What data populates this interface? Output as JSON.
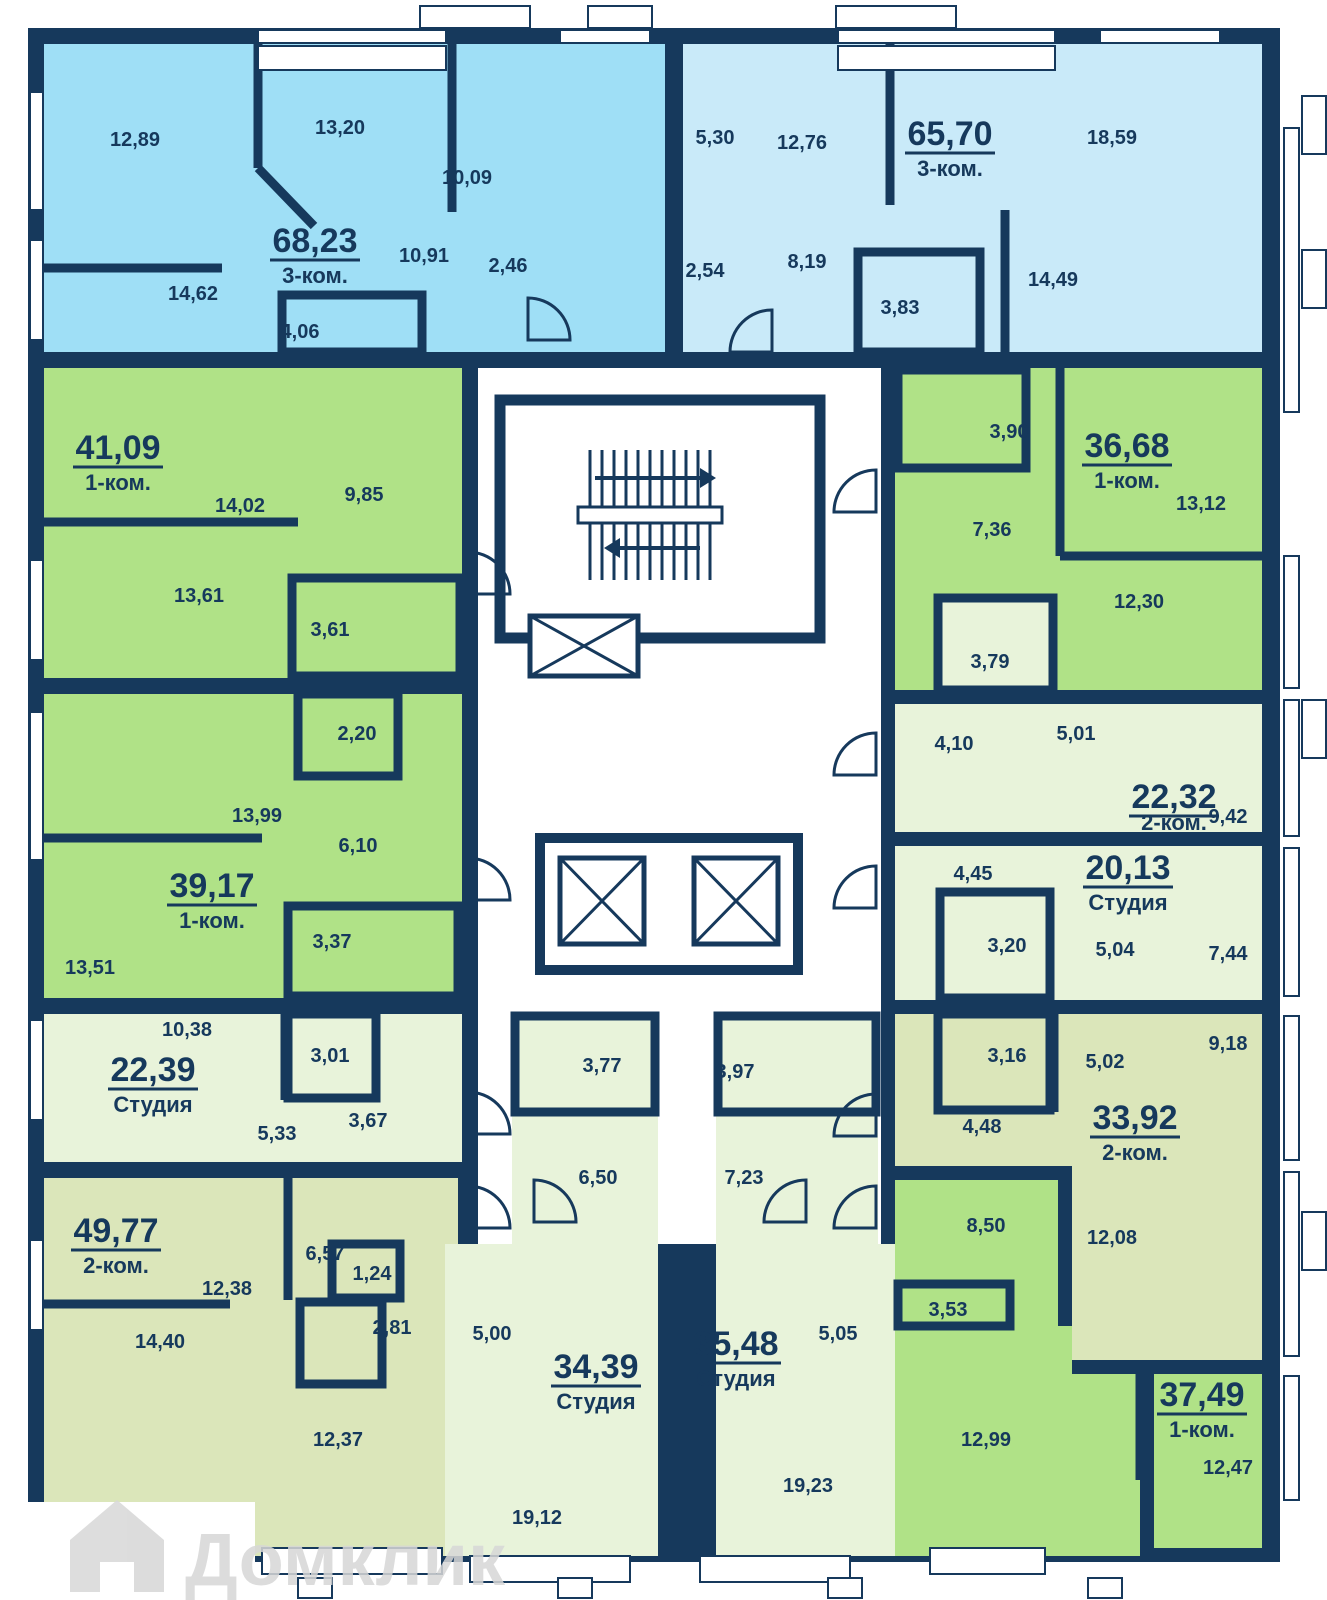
{
  "plan": {
    "watermark": "Домклик",
    "colors": {
      "wall": "#16395c",
      "bright_blue": "#9fdff6",
      "pale_blue": "#c9eaf9",
      "green": "#b0e287",
      "pale_green": "#e8f3da",
      "olive": "#dbe6ba",
      "background": "#ffffff"
    }
  },
  "apartments": [
    {
      "id": "68-23",
      "area": "68,23",
      "type": "3-ком.",
      "color": "#9fdff6",
      "rooms": [
        "12,89",
        "13,20",
        "10,09",
        "10,91",
        "2,46",
        "14,62",
        "4,06"
      ]
    },
    {
      "id": "65-70",
      "area": "65,70",
      "type": "3-ком.",
      "color": "#c9eaf9",
      "rooms": [
        "5,30",
        "12,76",
        "18,59",
        "2,54",
        "8,19",
        "3,83",
        "14,49"
      ]
    },
    {
      "id": "41-09",
      "area": "41,09",
      "type": "1-ком.",
      "color": "#b0e287",
      "rooms": [
        "14,02",
        "9,85",
        "13,61",
        "3,61"
      ]
    },
    {
      "id": "39-17",
      "area": "39,17",
      "type": "1-ком.",
      "color": "#b0e287",
      "rooms": [
        "13,99",
        "2,20",
        "6,10",
        "3,37",
        "13,51"
      ]
    },
    {
      "id": "22-39",
      "area": "22,39",
      "type": "Студия",
      "color": "#e8f3da",
      "rooms": [
        "10,38",
        "3,01",
        "5,33",
        "3,67"
      ]
    },
    {
      "id": "49-77",
      "area": "49,77",
      "type": "2-ком.",
      "color": "#dbe6ba",
      "rooms": [
        "6,57",
        "1,24",
        "12,38",
        "2,81",
        "14,40",
        "12,37"
      ]
    },
    {
      "id": "34-39",
      "area": "34,39",
      "type": "Студия",
      "color": "#e8f3da",
      "rooms": [
        "3,77",
        "6,50",
        "5,00",
        "19,12"
      ]
    },
    {
      "id": "35-48",
      "area": "35,48",
      "type": "Студия",
      "color": "#e8f3da",
      "rooms": [
        "3,97",
        "7,23",
        "5,05",
        "19,23"
      ]
    },
    {
      "id": "36-68",
      "area": "36,68",
      "type": "1-ком.",
      "color": "#b0e287",
      "rooms": [
        "3,90",
        "13,12",
        "7,36",
        "12,30"
      ]
    },
    {
      "id": "22-32",
      "area": "22,32",
      "type": "2-ком.",
      "color": "#e8f3da",
      "rooms": [
        "3,79",
        "4,10",
        "5,01",
        "9,42"
      ]
    },
    {
      "id": "20-13",
      "area": "20,13",
      "type": "Студия",
      "color": "#e8f3da",
      "rooms": [
        "4,45",
        "3,20",
        "5,04",
        "7,44"
      ]
    },
    {
      "id": "33-92",
      "area": "33,92",
      "type": "2-ком.",
      "color": "#dbe6ba",
      "rooms": [
        "3,16",
        "5,02",
        "9,18",
        "4,48",
        "12,08"
      ]
    },
    {
      "id": "37-49",
      "area": "37,49",
      "type": "1-ком.",
      "color": "#b0e287",
      "rooms": [
        "8,50",
        "3,53",
        "12,99",
        "12,47"
      ]
    }
  ]
}
